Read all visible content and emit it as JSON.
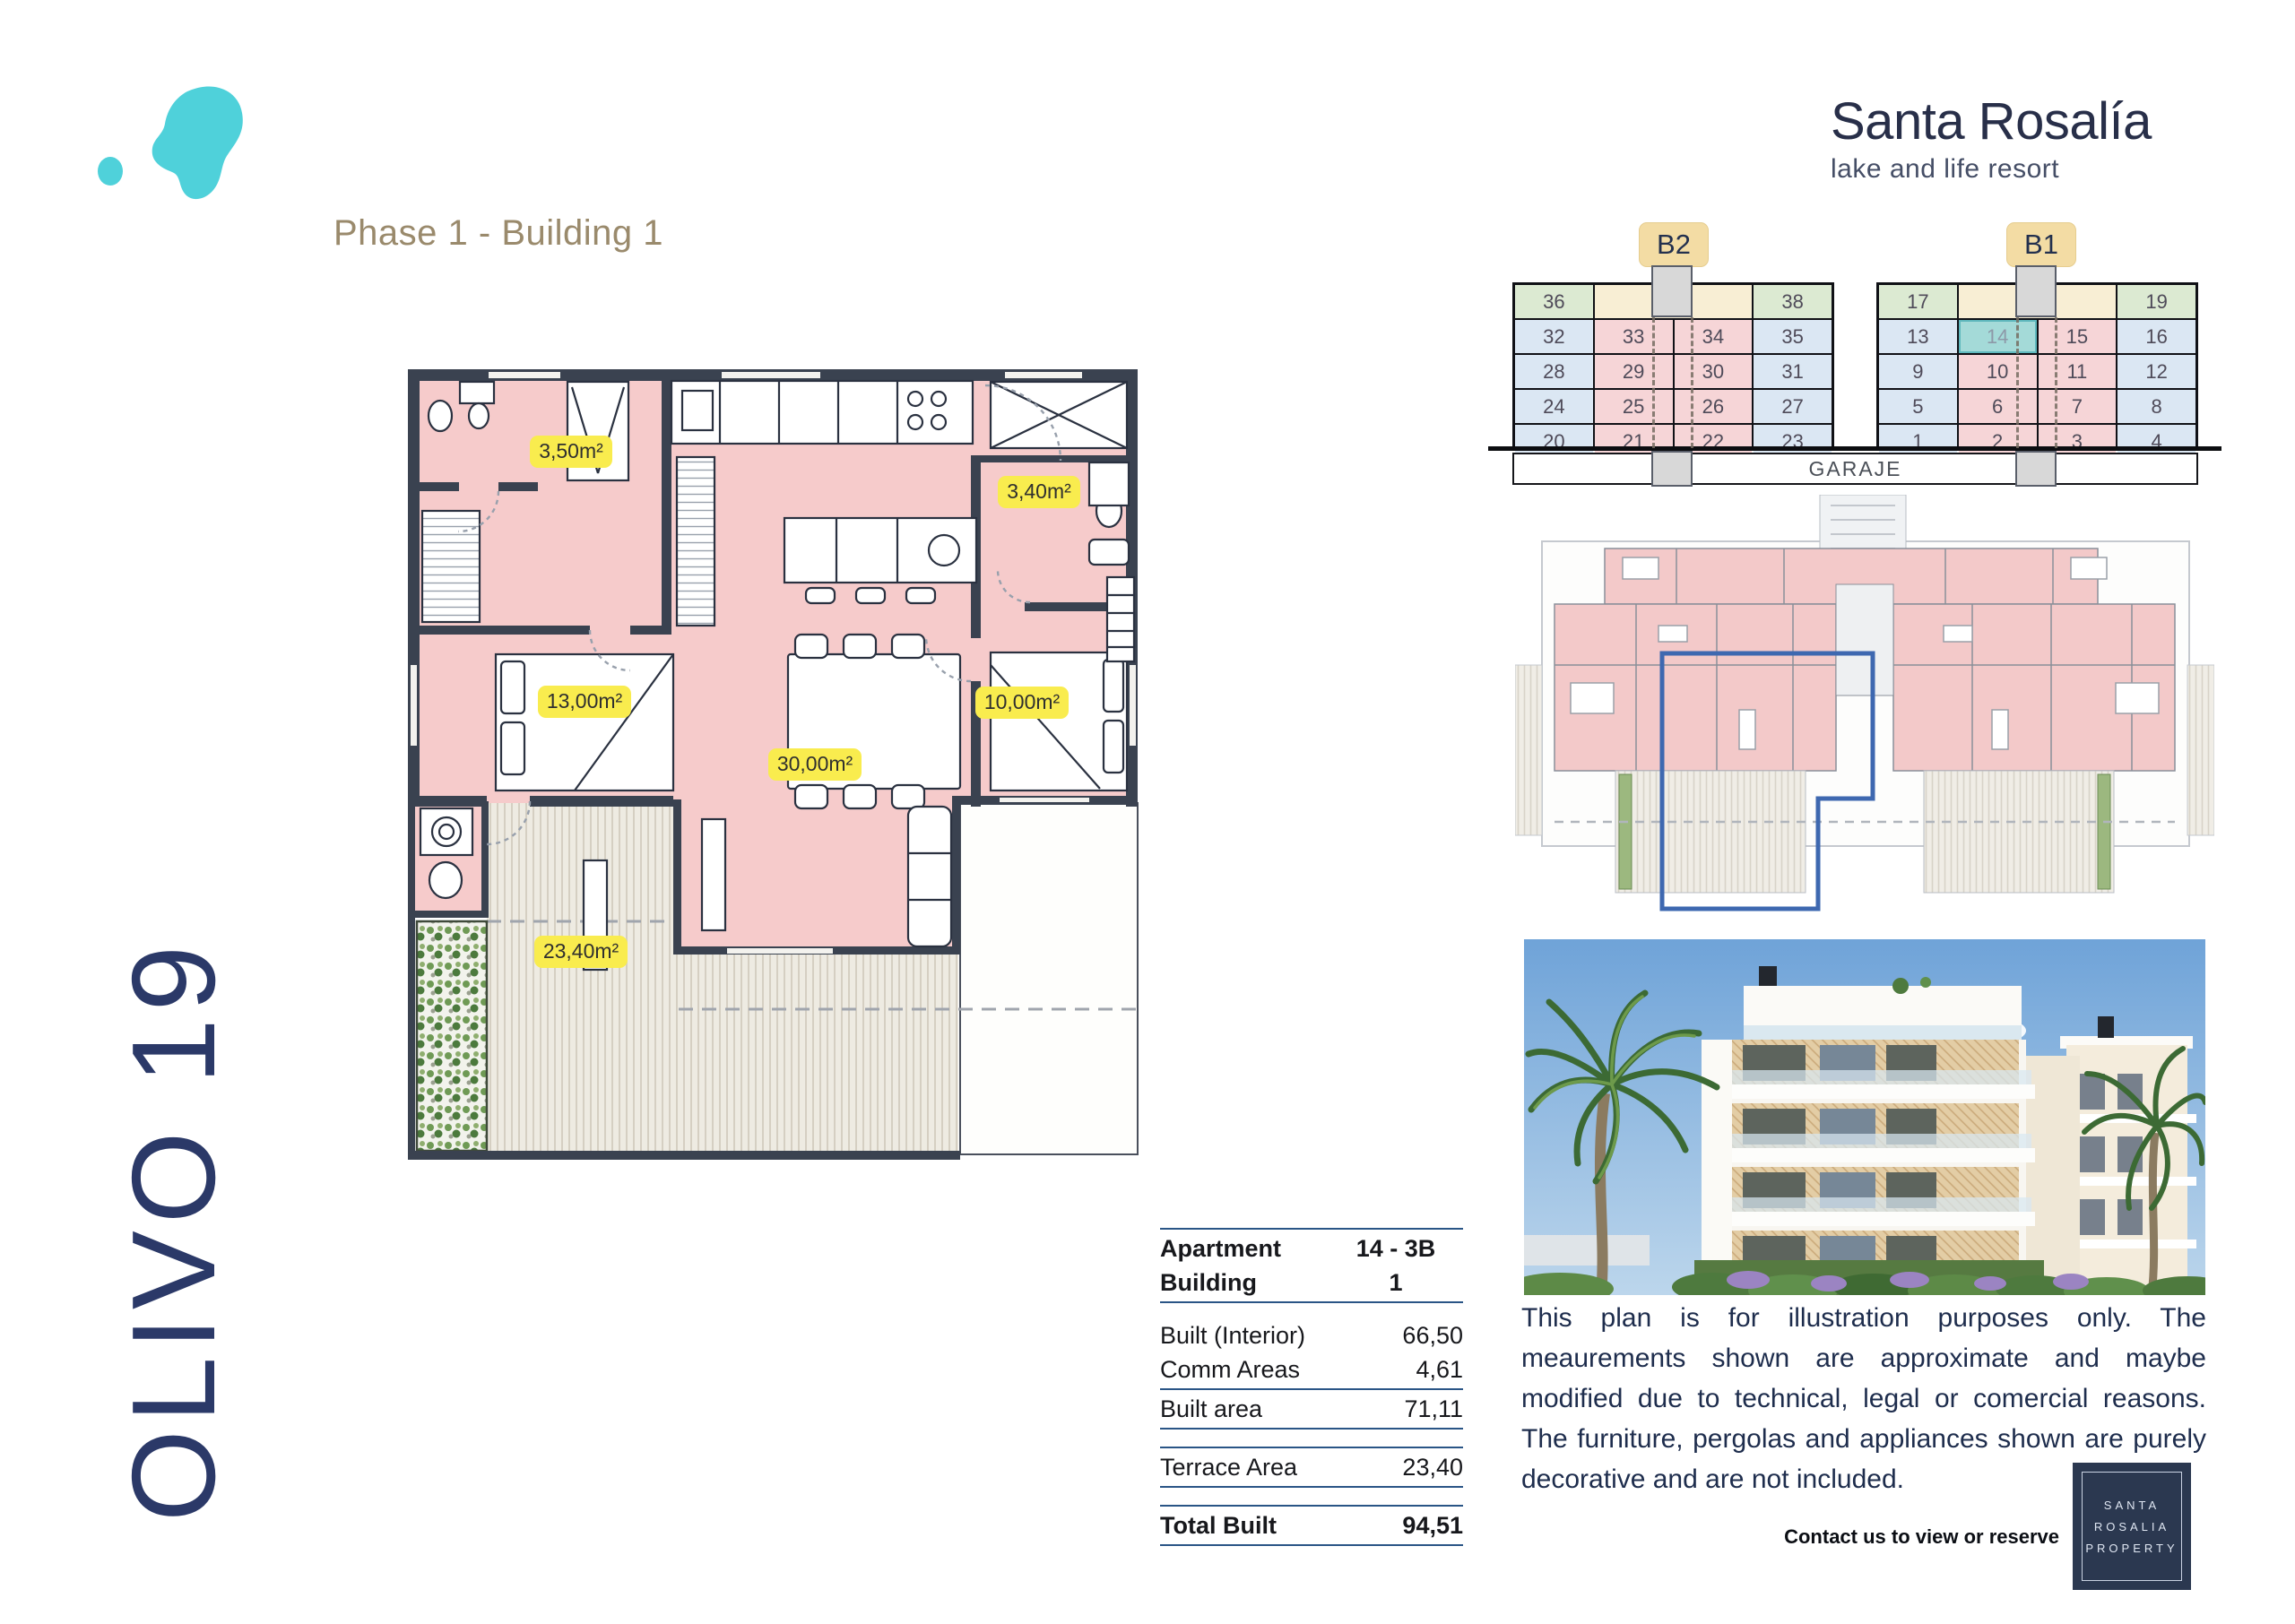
{
  "header": {
    "phase": "Phase 1 - Building 1",
    "brand_name": "Santa Rosalía",
    "brand_tagline": "lake and life resort"
  },
  "side": {
    "project": "OLIVO 19"
  },
  "floorplan": {
    "room_labels": [
      "3,50m²",
      "3,40m²",
      "13,00m²",
      "10,00m²",
      "30,00m²",
      "23,40m²"
    ]
  },
  "availability": {
    "garage": "GARAJE",
    "selected_unit": "14",
    "blocks": [
      {
        "tab": "B2",
        "rows": [
          [
            {
              "n": "36",
              "c": "green"
            },
            {
              "n": "37",
              "c": "cream",
              "span": 2
            },
            {
              "n": "38",
              "c": "green"
            }
          ],
          [
            {
              "n": "32",
              "c": "blue"
            },
            {
              "n": "33",
              "c": "pink"
            },
            {
              "n": "34",
              "c": "pink"
            },
            {
              "n": "35",
              "c": "blue"
            }
          ],
          [
            {
              "n": "28",
              "c": "blue"
            },
            {
              "n": "29",
              "c": "pink"
            },
            {
              "n": "30",
              "c": "pink"
            },
            {
              "n": "31",
              "c": "blue"
            }
          ],
          [
            {
              "n": "24",
              "c": "blue"
            },
            {
              "n": "25",
              "c": "pink"
            },
            {
              "n": "26",
              "c": "pink"
            },
            {
              "n": "27",
              "c": "blue"
            }
          ],
          [
            {
              "n": "20",
              "c": "blue"
            },
            {
              "n": "21",
              "c": "pink"
            },
            {
              "n": "22",
              "c": "pink"
            },
            {
              "n": "23",
              "c": "blue"
            }
          ]
        ]
      },
      {
        "tab": "B1",
        "rows": [
          [
            {
              "n": "17",
              "c": "green"
            },
            {
              "n": "18",
              "c": "cream",
              "span": 2
            },
            {
              "n": "19",
              "c": "green"
            }
          ],
          [
            {
              "n": "13",
              "c": "blue"
            },
            {
              "n": "14",
              "c": "sel"
            },
            {
              "n": "15",
              "c": "pink"
            },
            {
              "n": "16",
              "c": "blue"
            }
          ],
          [
            {
              "n": "9",
              "c": "blue"
            },
            {
              "n": "10",
              "c": "pink"
            },
            {
              "n": "11",
              "c": "pink"
            },
            {
              "n": "12",
              "c": "blue"
            }
          ],
          [
            {
              "n": "5",
              "c": "blue"
            },
            {
              "n": "6",
              "c": "pink"
            },
            {
              "n": "7",
              "c": "pink"
            },
            {
              "n": "8",
              "c": "blue"
            }
          ],
          [
            {
              "n": "1",
              "c": "blue"
            },
            {
              "n": "2",
              "c": "pink"
            },
            {
              "n": "3",
              "c": "pink"
            },
            {
              "n": "4",
              "c": "blue"
            }
          ]
        ]
      }
    ]
  },
  "details": {
    "items": [
      {
        "t": "line"
      },
      {
        "t": "row",
        "label": "Apartment",
        "value": "14 - 3B",
        "bold": true,
        "center": true
      },
      {
        "t": "row",
        "label": "Building",
        "value": "1",
        "bold": true,
        "center": true
      },
      {
        "t": "line"
      },
      {
        "t": "space"
      },
      {
        "t": "row",
        "label": "Built (Interior)",
        "value": "66,50"
      },
      {
        "t": "row",
        "label": "Comm Areas",
        "value": "4,61"
      },
      {
        "t": "line"
      },
      {
        "t": "row",
        "label": "Built area",
        "value": "71,11"
      },
      {
        "t": "line"
      },
      {
        "t": "space"
      },
      {
        "t": "line"
      },
      {
        "t": "row",
        "label": "Terrace Area",
        "value": "23,40"
      },
      {
        "t": "line"
      },
      {
        "t": "space"
      },
      {
        "t": "line"
      },
      {
        "t": "row",
        "label": "Total Built",
        "value": "94,51",
        "bold": true
      },
      {
        "t": "line"
      }
    ]
  },
  "disclaimer": {
    "text": "This plan is for illustration purposes only. The meaurements shown are approximate and maybe modified due to technical, legal or comercial reasons. The furniture, pergolas and appliances shown are purely decorative and are not included."
  },
  "contact": {
    "label": "Contact us to view or reserve"
  },
  "footer_logo": {
    "lines": [
      "SANTA",
      "ROSALIA",
      "PROPERTY"
    ]
  },
  "colors": {
    "accent_teal": "#4fd1da",
    "navy": "#2b3968",
    "plan_pink": "#f6cbcb",
    "label_yellow": "#f9ec4e",
    "highlight_blue": "#3e68b0",
    "cell_green": "#dcead2",
    "cell_blue": "#dbe7f3",
    "cell_pink": "#f6d5d7",
    "cell_cream": "#f8eed4",
    "cell_selected": "#a4dad8",
    "tab_tan": "#f3dca4",
    "wall_gray": "#3a4250",
    "table_line_blue": "#2a5586",
    "phase_tan": "#9a8a6c"
  }
}
